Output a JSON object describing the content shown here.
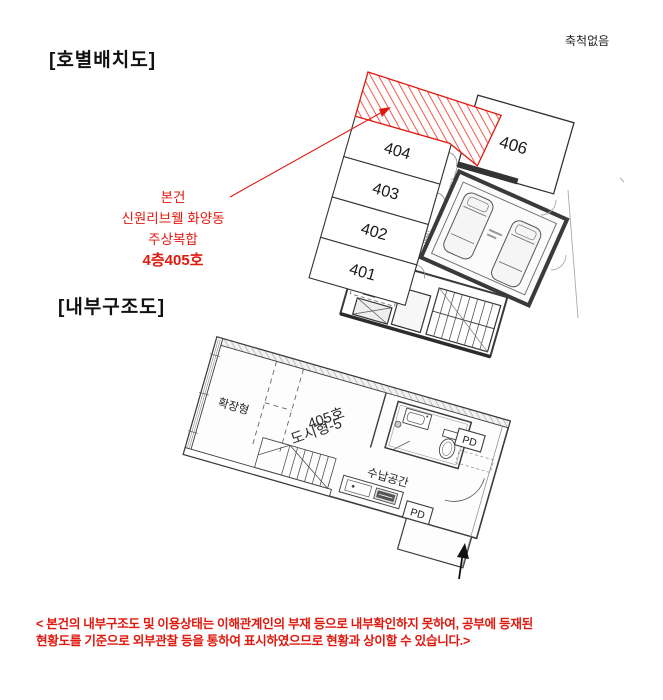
{
  "page": {
    "title_site": "[호별배치도]",
    "title_floor": "[내부구조도]",
    "scale_note": "축척없음"
  },
  "site_plan": {
    "units": [
      "404",
      "403",
      "402",
      "401"
    ],
    "unit_406": "406",
    "dim_1350": "1,350",
    "dim_1300": "1,300",
    "subject": {
      "line1": "본건",
      "line2": "신원리브웰 화양동",
      "line3": "주상복합",
      "line4": "4층405호"
    }
  },
  "floor_plan": {
    "room_expand": "확장형",
    "unit_line1": "405호",
    "unit_line2": "도시형-5",
    "storage": "수납공간",
    "pd1": "PD",
    "pd2": "PD"
  },
  "disclaimer": {
    "line1": "< 본건의 내부구조도 및 이용상태는 이해관계인의 부재 등으로 내부확인하지 못하여, 공부에  등재된",
    "line2": "현황도를 기준으로  외부관찰 등을 통하여 표시하였으므로 현황과 상이할 수 있습니다.>"
  },
  "colors": {
    "accent_red": "#e0190f",
    "line_dark": "#333333",
    "line_gray": "#888888"
  }
}
